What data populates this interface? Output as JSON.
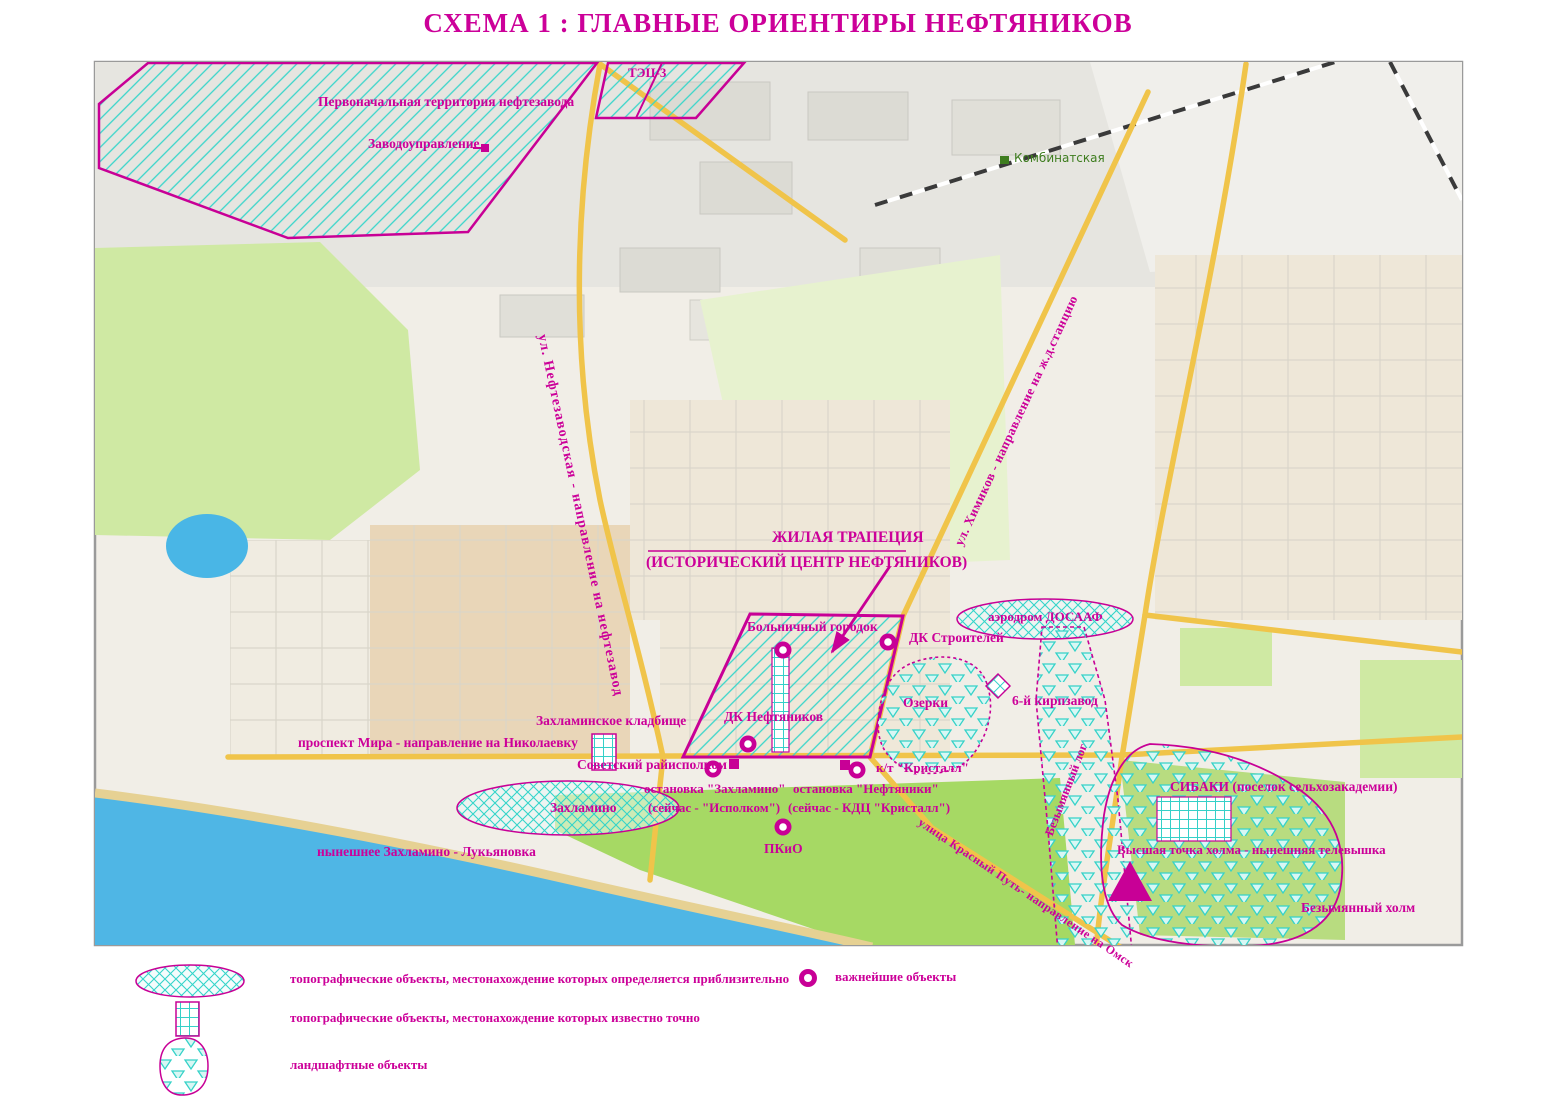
{
  "title": "СХЕМА 1 : ГЛАВНЫЕ ОРИЕНТИРЫ НЕФТЯНИКОВ",
  "map": {
    "station_label": "Комбинатская",
    "areas": {
      "refinery": "Первоначальная территория нефтезавода",
      "tec3": "ТЭЦ-3",
      "trapezoid_line1": "ЖИЛАЯ ТРАПЕЦИЯ",
      "trapezoid_line2": "(ИСТОРИЧЕСКИЙ ЦЕНТР  НЕФТЯНИКОВ)",
      "aerodrome": "аэродром ДОСААФ",
      "ozerki": "Озерки",
      "zakhlamino": "Захламино",
      "former_zakhlamino": "нынешнее Захламино - Лукьяновка",
      "sibaki": "СИБАКИ (поселок сельхозакадемии)",
      "log": "Безымянный лог",
      "kholm": "Безымянный холм"
    },
    "points": {
      "factory_office": "Заводоуправление",
      "hospital": "Больничный городок",
      "dk_stroiteley": "ДК Строителей",
      "dk_neftyanikov": "ДК Нефтяников",
      "brick_factory": "6-й кирпзавод",
      "cemetery": "Захламинское кладбище",
      "raiispolkom": "Советский райисполком",
      "stop_zakhlamino_line1": "остановка \"Захламино\"",
      "stop_zakhlamino_line2": "(сейчас - \"Исполком\")",
      "kt_kristall": "к/т  \"Кристалл\"",
      "stop_neftyaniki_line1": "остановка \"Нефтяники\"",
      "stop_neftyaniki_line2": "(сейчас - КДЦ \"Кристалл\")",
      "pkio": "ПКиО",
      "tv_tower": "Высшая точка холма - нынешняя телевышка"
    },
    "roads": {
      "neftezavodskaya": "ул. Нефтезаводская - направление на нефтезавод",
      "khimikov": "ул. Химиков - направление на ж.д.станцию",
      "mira": "проспект Мира - направление на Николаевку",
      "krasny_put": "улица Красный Путь- направление на Омск"
    }
  },
  "legend": {
    "approx": "топографические объекты, местонахождение которых определяется приблизительно",
    "exact": "топографические объекты, местонахождение которых известно точно",
    "landscape": "ландшафтные объекты",
    "important": "важнейшие объекты"
  },
  "colors": {
    "accent": "#cc0099",
    "hatch_cyan": "#38d5ca",
    "road_yellow": "#f2c846",
    "water_blue": "#4fb6e5",
    "forest_green": "#cfe9a3",
    "park_green": "#a6d964"
  }
}
